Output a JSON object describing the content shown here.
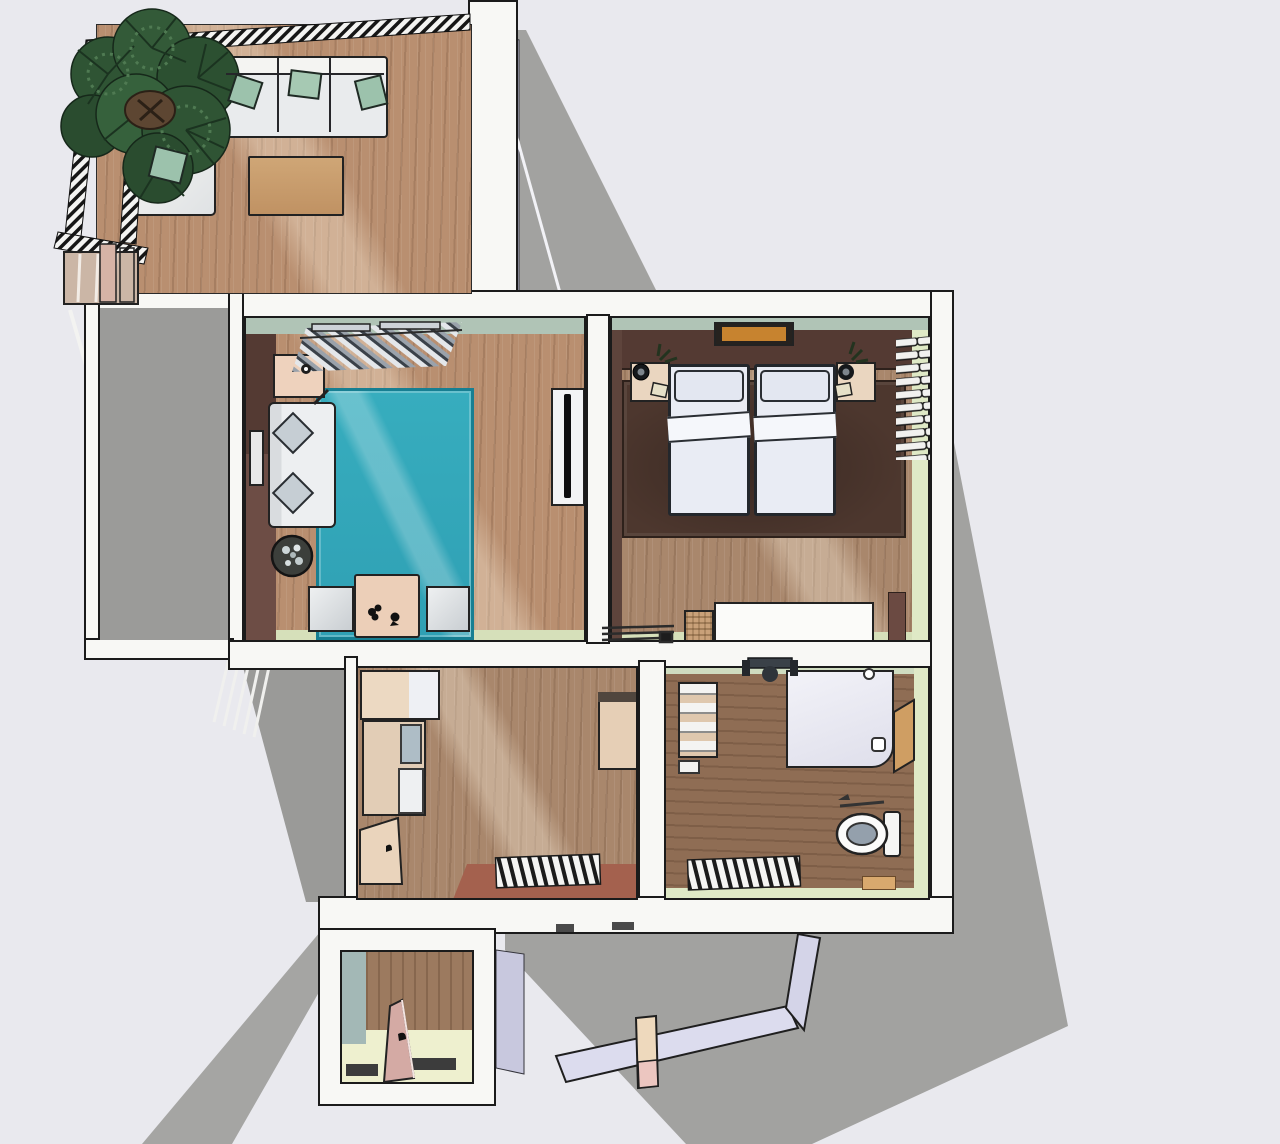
{
  "scene": {
    "description": "3D top-down architectural rendering of a furnished apartment floor plan casting a gray drop shadow on a light backdrop",
    "render_style": "sketch-textured axonometric, no visible text",
    "has_text": false
  },
  "palette": {
    "background": "#e9e9ee",
    "shadow": "#a2a2a0",
    "shadow_dark": "#9a9a98",
    "wall_white": "#f8f8f5",
    "outline": "#1b1b1b",
    "wood_light": "#b98f70",
    "wood_mid": "#a9876c",
    "wood_dark": "#8f6d54",
    "wood_vestibule": "#9c7a5f",
    "rug_teal": "#37adbe",
    "rug_teal_border": "#177f92",
    "rug_brown": "#4d372e",
    "wall_maroon": "#6d4d45",
    "wall_maroon_dark": "#543a33",
    "wall_sage": "#b0c4b6",
    "wall_green_light": "#dfe9c6",
    "wall_sage_light": "#d6e0ba",
    "furniture_cream": "#ead6c0",
    "furniture_tan": "#c9a06f",
    "pillow_green": "#9cc2ac",
    "sofa_white": "#edeff1",
    "bed_white": "#e9ecf4",
    "gray_floor": "#9b9b99",
    "vestibule_wall_teal": "#a3b8b6",
    "vestibule_floor": "#eef0cf",
    "door_pink": "#d4aaa4",
    "door_wood": "#cf9e63",
    "lavender": "#cdcde2",
    "entry_floor_red": "#a4614e",
    "tree_green": "#2f5434",
    "tree_green_dark": "#1b3320",
    "tree_trunk": "#5d4632"
  },
  "rooms": [
    {
      "id": "terrace",
      "name": "terrace balcony with palm tree and outdoor lounge",
      "furniture": [
        "palm-tree",
        "outdoor-sofa",
        "corner-armchair",
        "coffee-table",
        "slatted-railing",
        "planters"
      ]
    },
    {
      "id": "side-balcony",
      "name": "side balcony with slatted railing in shadow",
      "furniture": [
        "railing-slats"
      ]
    },
    {
      "id": "living-room",
      "name": "living room with teal area rug",
      "furniture": [
        "coat-rack-with-clothes",
        "side-table",
        "sofa-with-pillows",
        "wall-picture",
        "teal-rug",
        "potted-plant",
        "dining-table",
        "two-chairs",
        "tv-cabinet"
      ]
    },
    {
      "id": "bedroom",
      "name": "bedroom with twin beds",
      "furniture": [
        "wall-picture",
        "two-nightstands-with-lamps",
        "twin-beds",
        "brown-rug",
        "folded-clothes-shelf",
        "storage-bench",
        "wicker-basket",
        "radiator"
      ]
    },
    {
      "id": "hallway",
      "name": "hallway with wardrobe cabinets and shoe rack",
      "furniture": [
        "wardrobe-cabinets",
        "side-cabinet",
        "shoe-cabinet",
        "radiator",
        "red-entry-floor-strip"
      ]
    },
    {
      "id": "bathroom",
      "name": "bathroom with shower, toilet and radiator",
      "furniture": [
        "towel-shelf",
        "wall-faucet",
        "shower-tray",
        "wooden-door",
        "toilet",
        "radiator",
        "bath-mat"
      ]
    },
    {
      "id": "vestibule",
      "name": "entry vestibule with open pink door",
      "furniture": [
        "entry-door",
        "door-thresholds"
      ]
    }
  ],
  "exterior": {
    "elements": [
      "drop-shadow",
      "open-gate-beam",
      "gate-post-block",
      "lavender-wall-slivers"
    ]
  }
}
